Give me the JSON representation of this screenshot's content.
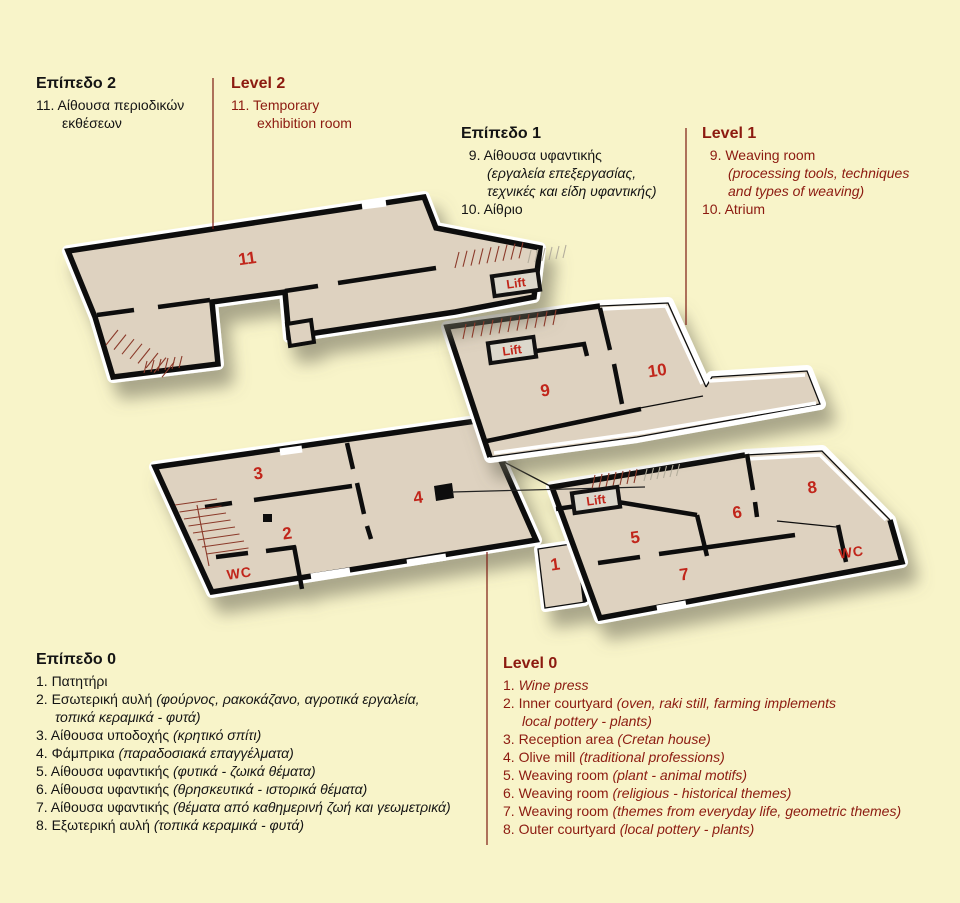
{
  "colors": {
    "background": "#f8f4c9",
    "floor": "#ded2c0",
    "wall": "#111111",
    "white_edge": "#ffffff",
    "room_number_red": "#c1261b",
    "english_maroon": "#8c1a10",
    "greek_black": "#141414",
    "leader_line": "#7c1a12",
    "stair_hatch": "#8b3a2a"
  },
  "legend": {
    "blocks": [
      {
        "id": "level2-greek",
        "cls": "gr ind26",
        "heading": "Επίπεδο 2",
        "items": [
          {
            "lines": [
              [
                {
                  "t": "11. Αίθουσα περιοδικών"
                }
              ],
              [
                {
                  "t": "εκθέσεων"
                }
              ]
            ]
          }
        ]
      },
      {
        "id": "level2-english",
        "cls": "en ind26",
        "heading": "Level 2",
        "items": [
          {
            "lines": [
              [
                {
                  "t": "11. Temporary"
                }
              ],
              [
                {
                  "t": "exhibition room"
                }
              ]
            ]
          }
        ]
      },
      {
        "id": "level1-greek",
        "cls": "gr ind26",
        "heading": "Επίπεδο 1",
        "items": [
          {
            "lines": [
              [
                {
                  "t": "  9. Αίθουσα υφαντικής"
                }
              ],
              [
                {
                  "t": "(εργαλεία επεξεργασίας,",
                  "i": true
                }
              ],
              [
                {
                  "t": "τεχνικές και είδη υφαντικής)",
                  "i": true
                }
              ]
            ]
          },
          {
            "lines": [
              [
                {
                  "t": "10. Αίθριο"
                }
              ]
            ]
          }
        ]
      },
      {
        "id": "level1-english",
        "cls": "en ind26",
        "heading": "Level 1",
        "items": [
          {
            "lines": [
              [
                {
                  "t": "  9. Weaving room"
                }
              ],
              [
                {
                  "t": "(processing tools, techniques",
                  "i": true
                }
              ],
              [
                {
                  "t": "and types of weaving)",
                  "i": true
                }
              ]
            ]
          },
          {
            "lines": [
              [
                {
                  "t": "10. Atrium"
                }
              ]
            ]
          }
        ]
      },
      {
        "id": "level0-greek",
        "cls": "gr ind19",
        "heading": "Επίπεδο 0",
        "items": [
          {
            "lines": [
              [
                {
                  "t": "1. Πατητήρι"
                }
              ]
            ]
          },
          {
            "lines": [
              [
                {
                  "t": "2. Εσωτερική αυλή "
                },
                {
                  "t": "(φούρνος, ρακοκάζανο, αγροτικά εργαλεία,",
                  "i": true
                }
              ],
              [
                {
                  "t": "τοπικά κεραμικά - φυτά)",
                  "i": true
                }
              ]
            ]
          },
          {
            "lines": [
              [
                {
                  "t": "3. Αίθουσα υποδοχής "
                },
                {
                  "t": "(κρητικό σπίτι)",
                  "i": true
                }
              ]
            ]
          },
          {
            "lines": [
              [
                {
                  "t": "4. Φάμπρικα "
                },
                {
                  "t": "(παραδοσιακά επαγγέλματα)",
                  "i": true
                }
              ]
            ]
          },
          {
            "lines": [
              [
                {
                  "t": "5. Αίθουσα υφαντικής "
                },
                {
                  "t": "(φυτικά - ζωικά θέματα)",
                  "i": true
                }
              ]
            ]
          },
          {
            "lines": [
              [
                {
                  "t": "6. Αίθουσα υφαντικής "
                },
                {
                  "t": "(θρησκευτικά - ιστορικά θέματα)",
                  "i": true
                }
              ]
            ]
          },
          {
            "lines": [
              [
                {
                  "t": "7. Αίθουσα υφαντικής "
                },
                {
                  "t": "(θέματα από καθημερινή ζωή και γεωμετρικά)",
                  "i": true
                }
              ]
            ]
          },
          {
            "lines": [
              [
                {
                  "t": "8. Εξωτερική αυλή "
                },
                {
                  "t": "(τοπικά κεραμικά - φυτά)",
                  "i": true
                }
              ]
            ]
          }
        ]
      },
      {
        "id": "level0-english",
        "cls": "en ind19",
        "heading": "Level 0",
        "items": [
          {
            "lines": [
              [
                {
                  "t": "1. "
                },
                {
                  "t": "Wine press",
                  "i": true
                }
              ]
            ]
          },
          {
            "lines": [
              [
                {
                  "t": "2. Inner courtyard "
                },
                {
                  "t": "(oven, raki still, farming implements",
                  "i": true
                }
              ],
              [
                {
                  "t": "local pottery - plants)",
                  "i": true
                }
              ]
            ]
          },
          {
            "lines": [
              [
                {
                  "t": "3. Reception area "
                },
                {
                  "t": "(Cretan house)",
                  "i": true
                }
              ]
            ]
          },
          {
            "lines": [
              [
                {
                  "t": "4. Olive mill "
                },
                {
                  "t": "(traditional professions)",
                  "i": true
                }
              ]
            ]
          },
          {
            "lines": [
              [
                {
                  "t": "5. Weaving room "
                },
                {
                  "t": "(plant - animal motifs)",
                  "i": true
                }
              ]
            ]
          },
          {
            "lines": [
              [
                {
                  "t": "6. Weaving room "
                },
                {
                  "t": "(religious - historical themes)",
                  "i": true
                }
              ]
            ]
          },
          {
            "lines": [
              [
                {
                  "t": "7. Weaving room "
                },
                {
                  "t": "(themes from everyday life, geometric themes)",
                  "i": true
                }
              ]
            ]
          },
          {
            "lines": [
              [
                {
                  "t": "8. Outer courtyard "
                },
                {
                  "t": "(local pottery - plants)",
                  "i": true
                }
              ]
            ]
          }
        ]
      }
    ]
  },
  "plan": {
    "rooms": [
      {
        "n": "11",
        "x": 248,
        "y": 264
      },
      {
        "n": "9",
        "x": 546,
        "y": 396
      },
      {
        "n": "10",
        "x": 658,
        "y": 376
      },
      {
        "n": "3",
        "x": 259,
        "y": 479
      },
      {
        "n": "2",
        "x": 288,
        "y": 539
      },
      {
        "n": "4",
        "x": 419,
        "y": 503
      },
      {
        "n": "1",
        "x": 556,
        "y": 570
      },
      {
        "n": "5",
        "x": 636,
        "y": 543
      },
      {
        "n": "6",
        "x": 738,
        "y": 518
      },
      {
        "n": "7",
        "x": 685,
        "y": 580
      },
      {
        "n": "8",
        "x": 813,
        "y": 493
      }
    ],
    "lifts": [
      {
        "label": "Lift",
        "x": 516,
        "y": 283
      },
      {
        "label": "Lift",
        "x": 512,
        "y": 350
      },
      {
        "label": "Lift",
        "x": 596,
        "y": 500
      }
    ],
    "wcs": [
      {
        "label": "WC",
        "x": 240,
        "y": 578
      },
      {
        "label": "WC",
        "x": 852,
        "y": 557
      }
    ]
  }
}
